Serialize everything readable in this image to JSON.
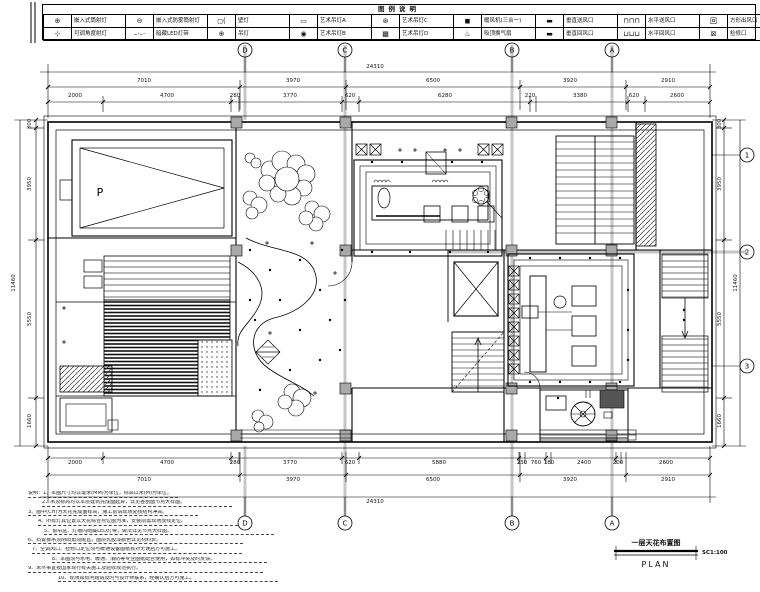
{
  "legend": {
    "title": "图例说明",
    "rows": [
      {
        "cells": [
          {
            "glyph": "⊕",
            "label": "嵌入式筒射灯"
          },
          {
            "glyph": "⊖",
            "label": "嵌入式防雾筒射灯"
          },
          {
            "glyph": "◻(",
            "label": "壁灯"
          },
          {
            "glyph": "▭",
            "label": "艺术吊灯A"
          },
          {
            "glyph": "⊛",
            "label": "艺术吊灯C"
          },
          {
            "glyph": "◼",
            "label": "暖风机(三合一)"
          },
          {
            "glyph": "▬",
            "label": "垂直送风口"
          },
          {
            "glyph": "⊓⊓⊓",
            "label": "水平送风口"
          },
          {
            "glyph": "回",
            "label": "方形出风口"
          }
        ]
      },
      {
        "cells": [
          {
            "glyph": "⊹",
            "label": "可调角度射灯"
          },
          {
            "glyph": "–·–·",
            "label": "暗藏LED灯带"
          },
          {
            "glyph": "⊕",
            "label": "吊灯"
          },
          {
            "glyph": "◉",
            "label": "艺术吊灯B"
          },
          {
            "glyph": "▩",
            "label": "艺术吊灯D"
          },
          {
            "glyph": "♨",
            "label": "吸顶换气扇"
          },
          {
            "glyph": "▬",
            "label": "垂直回风口"
          },
          {
            "glyph": "⊔⊔⊔",
            "label": "水平回风口"
          },
          {
            "glyph": "⊠",
            "label": "检修口"
          }
        ]
      }
    ]
  },
  "grid": {
    "top": [
      "D",
      "C",
      "B",
      "A"
    ],
    "bottom": [
      "D",
      "C",
      "B",
      "A"
    ],
    "right": [
      "1",
      "2",
      "3"
    ]
  },
  "dims": {
    "top_total": "24310",
    "top_major": [
      "7010",
      "3970",
      "6500",
      "3920",
      "2910"
    ],
    "top_minor": [
      "2000",
      "4700",
      "280",
      "3770",
      "620",
      "6280",
      "220",
      "3380",
      "620",
      "2600"
    ],
    "bottom_minor": [
      "2000",
      "4700",
      "280",
      "3770",
      "620",
      "5880",
      "230",
      "760",
      "180",
      "2400",
      "200",
      "2600"
    ],
    "bottom_major": [
      "7010",
      "3970",
      "6500",
      "3920",
      "2910"
    ],
    "bottom_total": "24310",
    "left": [
      "300",
      "3950",
      "5550",
      "1660"
    ],
    "left_total": "11460",
    "right": [
      "300",
      "3950",
      "5550",
      "1660"
    ],
    "right_total": "11460"
  },
  "plan": {
    "parking_label": "P"
  },
  "title_block": {
    "title": "一层天花布置图",
    "plan_word": "PLAN",
    "scale": "SC1:100"
  },
  "notes": {
    "items": [
      "说明：1、本图尺寸均以毫米(MM)为单位，标高以米(M)为单位。",
      "2、吊顶标高均以本层建筑完成面起算，详见各剖面节点大样图。",
      "3、图中(CH)为天花完成面标高，施工前请现场复核结构净高。",
      "4、所有灯具位置以天花综合点位图为准，安装前需现场放线定位。",
      "5、窗帘盒、灯槽内暗藏LED灯带，做法详见节点大样图。",
      "6、石膏板吊顶阴阳角须顺直，面层乳胶漆颜色详见材料表。",
      "7、空调风口、检修口定位须与暖通设备图纸核对无误后方可施工。",
      "8、本图须与水电、暖通、消防等专业图纸配合使用，如有冲突及时反馈。",
      "9、未尽事宜按国家现行有关施工及验收规范执行。",
      "10、现场如有问题请及时与设计师联系，经确认后方可施工。"
    ]
  }
}
